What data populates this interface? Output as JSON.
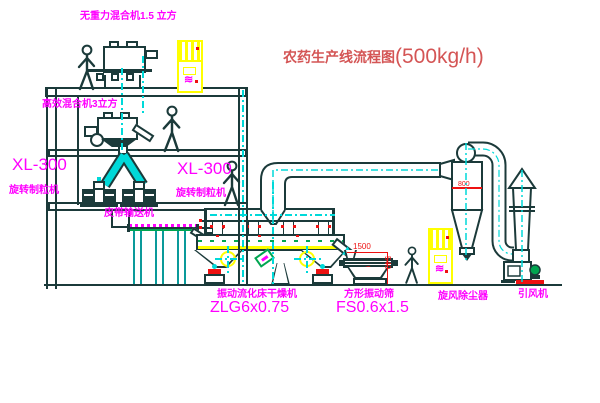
{
  "title": {
    "cn": "农药生产线流程图",
    "capacity": "(500kg/h)"
  },
  "labels": {
    "top_mixer": "无重力混合机1.5 立方",
    "floor2_mixer": "高效混合机3立方",
    "granulator_left_model": "XL-300",
    "granulator_left_name": "旋转制粒机",
    "granulator_mid_model": "XL-300",
    "granulator_mid_name": "旋转制粒机",
    "belt_conveyor": "皮带输送机",
    "dryer_name": "振动流化床干燥机",
    "dryer_model": "ZLG6x0.75",
    "sieve_name": "方形振动筛",
    "sieve_model": "FS0.6x1.5",
    "cyclone": "旋风除尘器",
    "fan": "引风机"
  },
  "dimensions": {
    "sieve_length": "1500",
    "sieve_height": "540",
    "cyclone_dia": "800"
  },
  "icons": {
    "wave_mark": "≋"
  },
  "colors": {
    "line_ink": "#1b3a3a",
    "centerline_cyan": "#00d9d9",
    "annotation_magenta": "#ff00ff",
    "title_red": "#d45555",
    "equipment_yellow": "#ffff00",
    "alert_red": "#ee1111",
    "machine_green": "#00a550"
  }
}
